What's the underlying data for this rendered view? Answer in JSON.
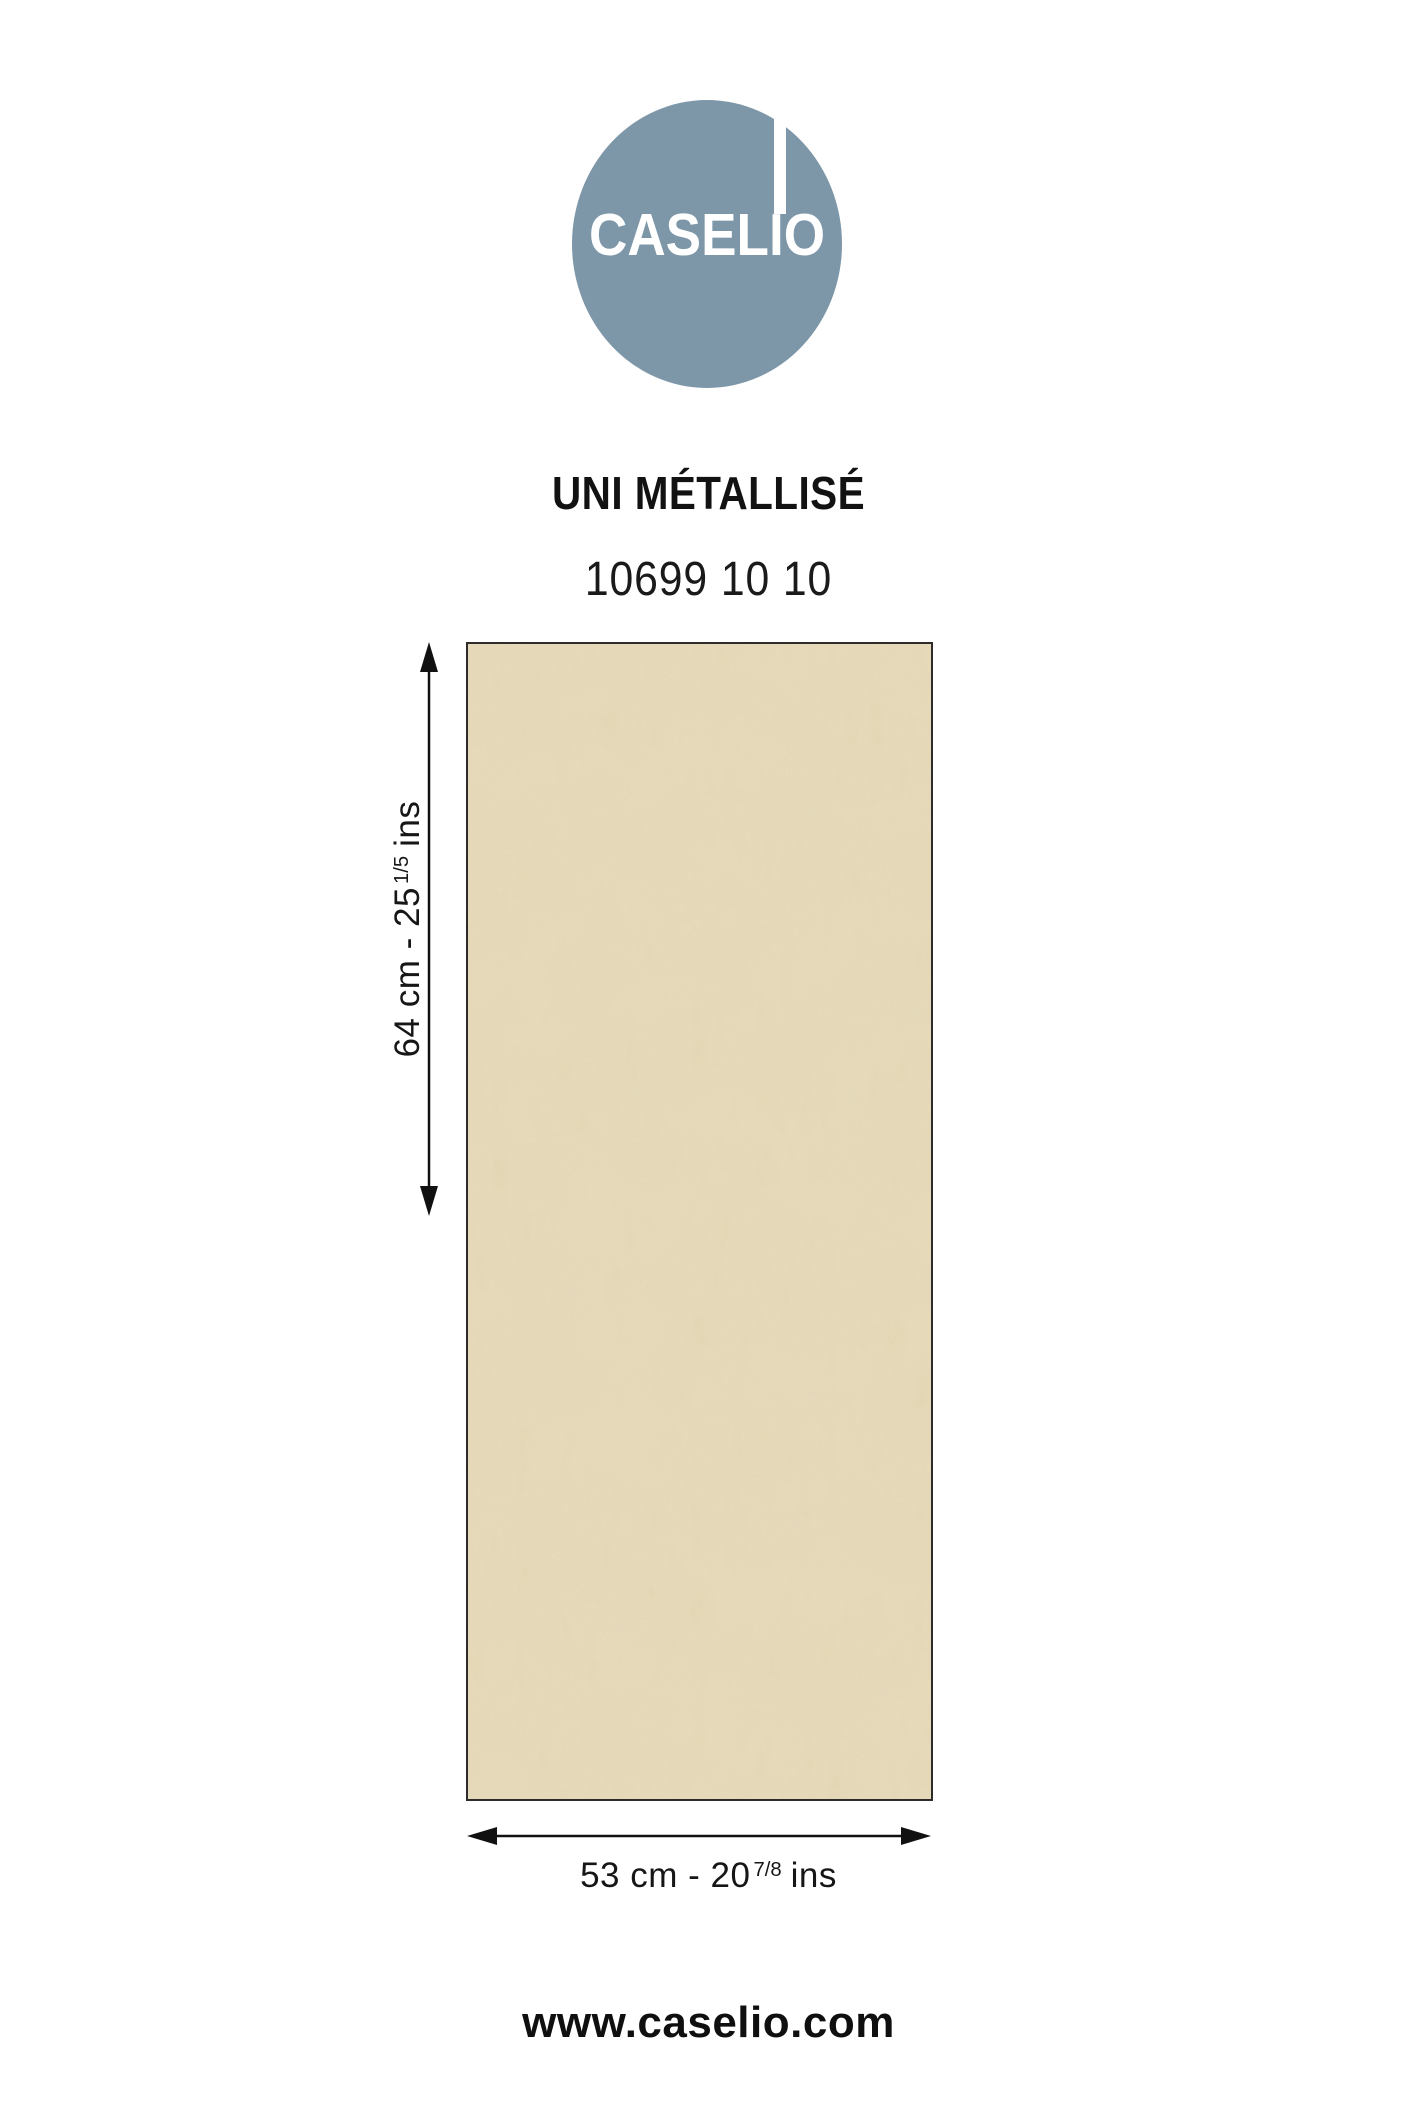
{
  "logo": {
    "brand": "CASELIO",
    "circle_color": "#7d97a9",
    "accent_bar_color": "#ffffff",
    "text_color": "#ffffff"
  },
  "product": {
    "name": "UNI MÉTALLISÉ",
    "reference": "10699 10 10"
  },
  "swatch": {
    "description": "beige metallic plaster-effect wallpaper sample",
    "base_color": "#e6dabb",
    "border_color": "#2e2c28"
  },
  "dimensions": {
    "height": {
      "prefix": "64 cm - 25",
      "fraction": "1/5",
      "unit": "ins"
    },
    "width": {
      "prefix": "53 cm - 20",
      "fraction": "7/8",
      "unit": "ins"
    }
  },
  "arrows": {
    "color": "#111111"
  },
  "footer": {
    "website": "www.caselio.com"
  }
}
